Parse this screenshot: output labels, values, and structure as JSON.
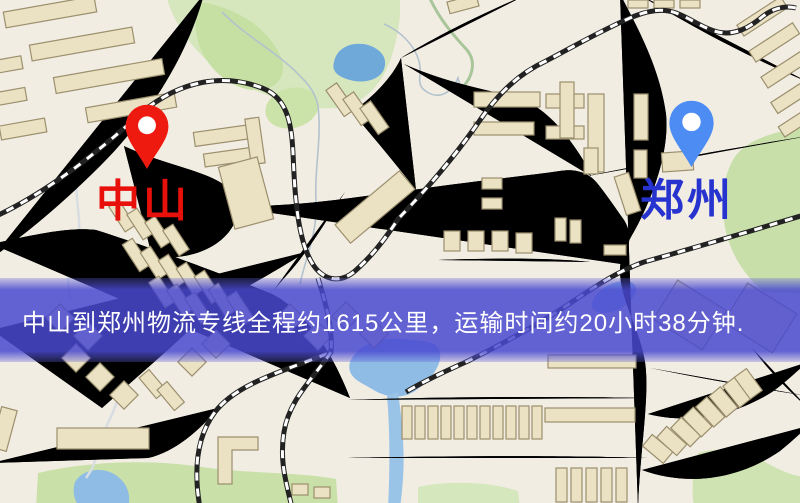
{
  "banner": {
    "text": "中山到郑州物流专线全程约1615公里，运输时间约20小时38分钟.",
    "background_color": "#4949d0",
    "text_color": "#ffffff",
    "distance_text": "1615公里",
    "duration_text": "20小时38分钟"
  },
  "markers": {
    "origin": {
      "name": "中山",
      "pin_color": "#ee1a10",
      "label_color": "#e8100b"
    },
    "destination": {
      "name": "郑州",
      "pin_color": "#4d8cf3",
      "label_color": "#2633cf"
    }
  },
  "map_palette": {
    "background": "#f2ede3",
    "road_fill": "#f7d170",
    "road_casing": "#e7b14b",
    "building": "#ebe2c4",
    "park": "#cfe4ad",
    "water": "#74aad9",
    "railway": "#222222"
  }
}
